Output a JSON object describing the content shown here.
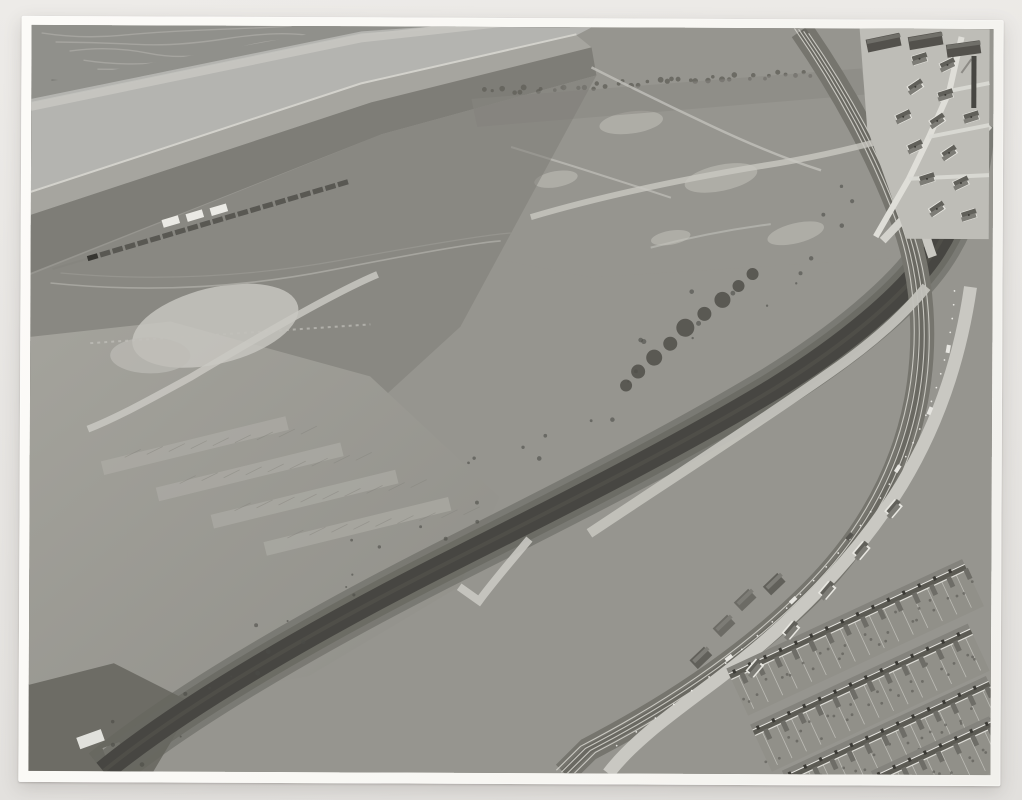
{
  "photo": {
    "medium": "black-and-white aerial photograph (gelatin silver print on cream mount)",
    "caption": "Aerial view of a large sawtooth-roofed factory works beside a canal and railway, with a river and salt-marsh beyond, open playing fields, sidings with a goods train, and terraced housing at lower right",
    "mount_background": "#e8e6e3",
    "paper_color": "#f9f8f4"
  },
  "palette": {
    "base": "#95948e",
    "marsh": "#8f8f8a",
    "creek": "#a9a8a3",
    "water": "#b4b4b0",
    "waterlight": "#c6c5c1",
    "sand": "#d5d4ce",
    "mud": "#a5a49e",
    "scrub": "#7d7c76",
    "darkscrub": "#67665f",
    "waste": "#95948e",
    "wastelight": "#b9b8b1",
    "trail": "#c2c1bb",
    "field": "#9d9c95",
    "fielddark": "#8f8e88",
    "strip": "#b2b1aa",
    "roofA": "#d7d6d1",
    "roofB": "#cbcac5",
    "roofHalf": "#c2c1bc",
    "ridge": "#e9e8e3",
    "gable": "#e4e3de",
    "gableShadow": "#57564f",
    "darkroof": "#8a8983",
    "wall": "#c9c8c2",
    "wallband": "#514f4a",
    "office": "#e0dfda",
    "window": "#6a6963",
    "stack": "#383732",
    "canal": "#45443f",
    "bank": "#63625b",
    "railbed": "#74736c",
    "rail": "#d1d0ca",
    "road": "#c9c8c2",
    "roadlight": "#d3d2cc",
    "yard": "#c3c2bc",
    "carlight": "#e7e6e1",
    "cardark": "#54534e",
    "truckbody": "#d8d7d1",
    "truckcab": "#403f3b",
    "tree": "#4d4c47",
    "terraceLit": "#83827c",
    "terraceShade": "#5a5952",
    "eaves": "#e9e8e2",
    "garden": "#908f88",
    "fence": "#c4c3bd",
    "village": "#bebdb7",
    "houseRoof": "#5f5e58",
    "houseRoofLit": "#7c7b75",
    "houseWall": "#e8e7e1",
    "shed": "#514f4a",
    "coal": "#4a4945",
    "white": "#f0efea"
  },
  "scene": {
    "features": [
      "river-estuary",
      "salt-marsh",
      "goods-train-sidings",
      "power-house",
      "coal-heap",
      "car-park",
      "sawtooth-factory",
      "roof-vent-stacks",
      "chimney-clusters",
      "office-block",
      "lorry-yard",
      "canal",
      "railway-main-line",
      "main-road",
      "playing-field",
      "small-warehouse",
      "terraced-houses",
      "village-cottages"
    ],
    "counts": {
      "sawtooth_bays": 13,
      "train_wagons": 21,
      "carpark_cars": 26,
      "yard_trucks": 12,
      "office_window_cols": 15,
      "office_window_rows": 3,
      "dense_roof_stack_rows": 6,
      "dense_roof_stack_cols": 11,
      "scattered_roof_stacks": 28,
      "chimney_clusters": 10,
      "terrace_rows": 4,
      "village_cottages": 13
    }
  }
}
